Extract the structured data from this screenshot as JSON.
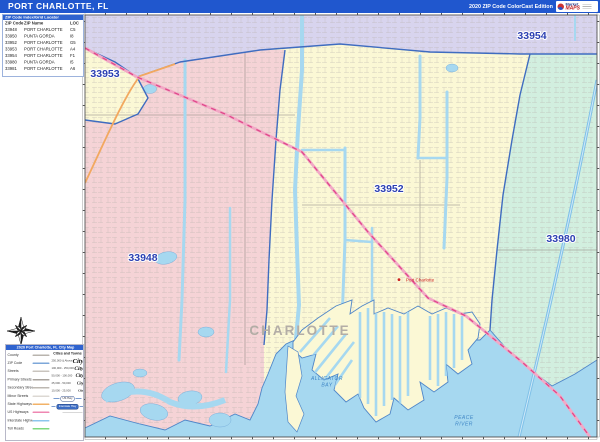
{
  "title_bar": {
    "title": "PORT CHARLOTTE, FL",
    "edition": "2020 ZIP Code ColorCast Edition",
    "logo_text_primary": "Market",
    "logo_text_secondary": "MAPS"
  },
  "zip_table": {
    "header": "ZIP Code Index/Grid Locator",
    "columns": [
      "ZIP Code",
      "ZIP Name",
      "LOC"
    ],
    "rows": [
      [
        "33948",
        "PORT CHARLOTTE",
        "C5"
      ],
      [
        "33950",
        "PUNTA GORDA",
        "I8"
      ],
      [
        "33952",
        "PORT CHARLOTTE",
        "G5"
      ],
      [
        "33953",
        "PORT CHARLOTTE",
        "A4"
      ],
      [
        "33954",
        "PORT CHARLOTTE",
        "F1"
      ],
      [
        "33980",
        "PUNTA GORDA",
        "I5"
      ],
      [
        "33981",
        "PORT CHARLOTTE",
        "A6"
      ]
    ]
  },
  "map": {
    "zip_labels": [
      {
        "text": "33953"
      },
      {
        "text": "33954"
      },
      {
        "text": "33952"
      },
      {
        "text": "33948"
      },
      {
        "text": "33980"
      }
    ],
    "county_label": "CHARLOTTE",
    "city_label": "Port Charlotte",
    "water_labels": {
      "bay_line1": "ALLIGATOR",
      "bay_line2": "BAY",
      "river_line1": "PEACE",
      "river_line2": "RIVER"
    }
  },
  "legend": {
    "title": "2020 Port Charlotte, FL City Map",
    "line_items": [
      {
        "label": "County",
        "color": "#b9b4ae"
      },
      {
        "label": "ZIP Code",
        "color": "#7da7d9"
      },
      {
        "label": "Streets",
        "color": "#c9c4be"
      },
      {
        "label": "Primary Streets",
        "color": "#a8a39d"
      },
      {
        "label": "Secondary Streets",
        "color": "#bdb8b2"
      },
      {
        "label": "Minor Streets",
        "color": "#dcd8d3"
      },
      {
        "label": "State Highways",
        "color": "#f2b267"
      },
      {
        "label": "US Highways",
        "color": "#ef87b2"
      },
      {
        "label": "Interstate Highways",
        "color": "#8cc6ec"
      },
      {
        "label": "Toll Roads",
        "color": "#7ed87e"
      }
    ],
    "cities_header": "Cities and Towns",
    "city_sizes": [
      {
        "range": "250,000 & Above",
        "sample": "City"
      },
      {
        "range": "100,000 - 250,000",
        "sample": "City"
      },
      {
        "range": "50,000 - 100,000",
        "sample": "City"
      },
      {
        "range": "25,000 - 50,000",
        "sample": "City"
      },
      {
        "range": "10,000 - 25,000",
        "sample": "City"
      }
    ],
    "shields": [
      {
        "label": "US Hwy"
      },
      {
        "label": "Interstate Hwy"
      }
    ]
  },
  "colors": {
    "title_bar": "#2057ce",
    "region_33954_33953_purple": "#d8d4ee",
    "region_33952_yellow": "#fbf8d5",
    "region_33948_pink": "#f5d3d6",
    "region_33980_green": "#d2efdf",
    "water": "#a6d8f0",
    "zip_boundary": "#3f6cc0",
    "us_highway": "#e0488a",
    "state_highway": "#f2a85f",
    "interstate": "#7fc0e8",
    "zip_label_text": "#2b3fb2",
    "county_label_text": "#b3ada6",
    "city_label_text": "#cc2222"
  }
}
